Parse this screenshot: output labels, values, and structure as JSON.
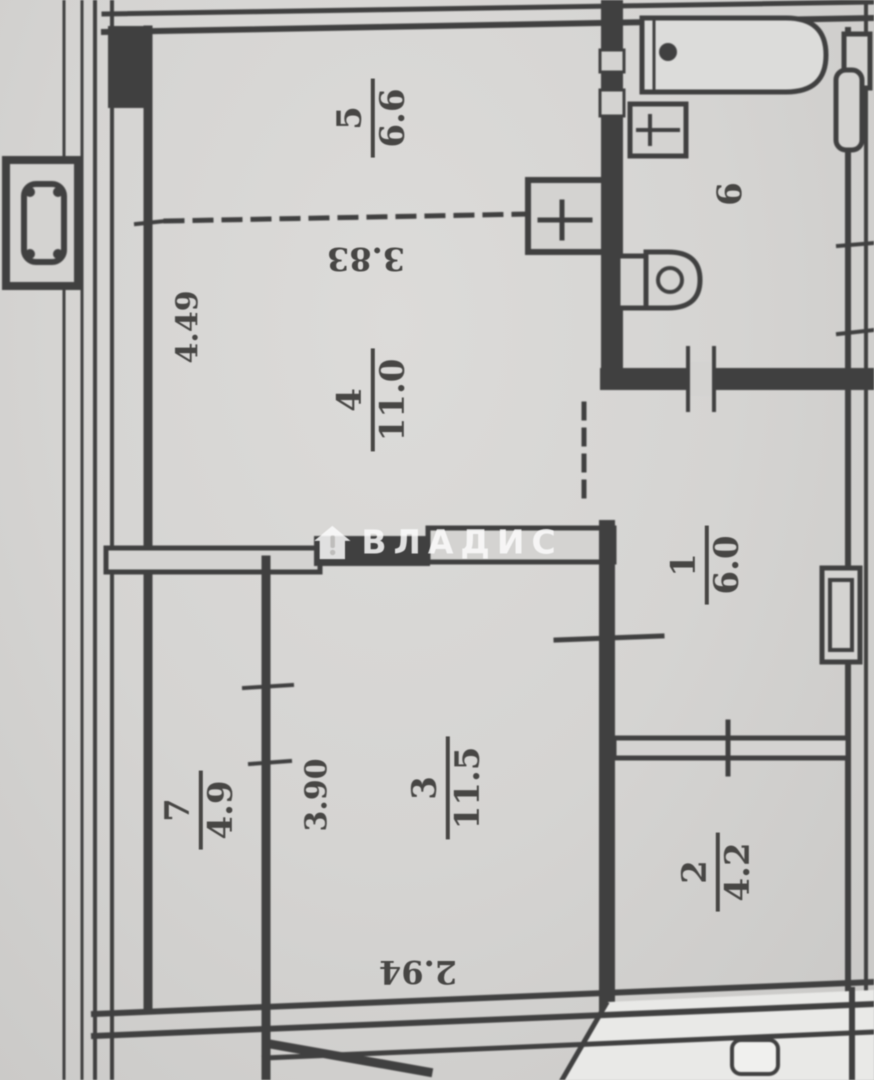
{
  "plan": {
    "type": "apartment-floor-plan-scan",
    "watermark": {
      "brand_text": "ВЛАДИС"
    },
    "rooms": {
      "room5": {
        "number": "5",
        "area": "6.6"
      },
      "room4": {
        "number": "4",
        "area": "11.0"
      },
      "room6": {
        "number": "6"
      },
      "room1": {
        "number": "1",
        "area": "6.0"
      },
      "room3": {
        "number": "3",
        "area": "11.5"
      },
      "room7": {
        "number": "7",
        "area": "4.9"
      },
      "room2": {
        "number": "2",
        "area": "4.2"
      }
    },
    "dimensions": {
      "room5_width": "3.83",
      "left_height": "4.49",
      "room3_height": "3.90",
      "room3_width": "2.94"
    },
    "colors": {
      "paper": "#d6d5d3",
      "ink": "#3f3f3f",
      "watermark": "#fafafa"
    }
  }
}
